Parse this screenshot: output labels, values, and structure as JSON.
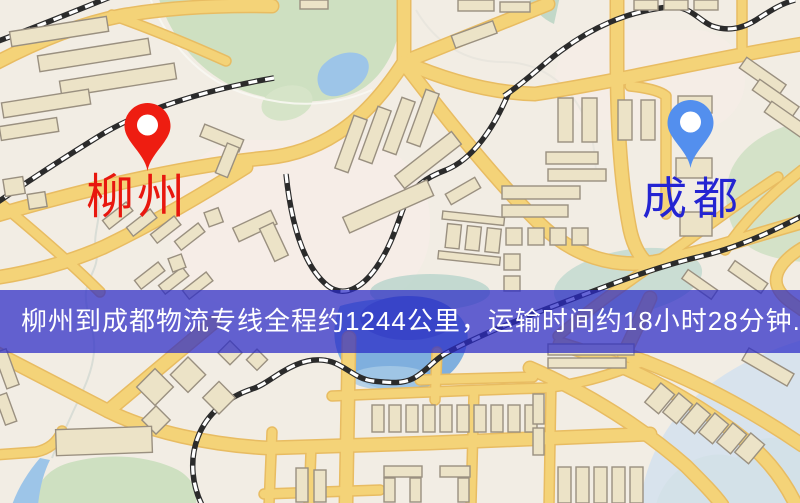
{
  "map": {
    "origin": {
      "name": "柳州",
      "pin_color": "#ee1d11",
      "label_color": "#e8170e"
    },
    "destination": {
      "name": "成都",
      "pin_color": "#538fee",
      "label_color": "#2424d2"
    }
  },
  "banner": {
    "text": "柳州到成都物流专线全程约1244公里，运输时间约18小时28分钟.",
    "background_color": "rgba(42,42,198,0.72)",
    "text_color": "#ffffff",
    "origin": "柳州",
    "destination": "成都",
    "distance_text": "约1244公里",
    "duration_text": "约18小时28分钟"
  },
  "palette": {
    "background": "#f2ede4",
    "road": "#f4d378",
    "road_casing": "#e8bc62",
    "park": "#cee0c1",
    "water": "#9dc5e8",
    "building": "#ece3c7",
    "railway": "#2b2b2b"
  }
}
